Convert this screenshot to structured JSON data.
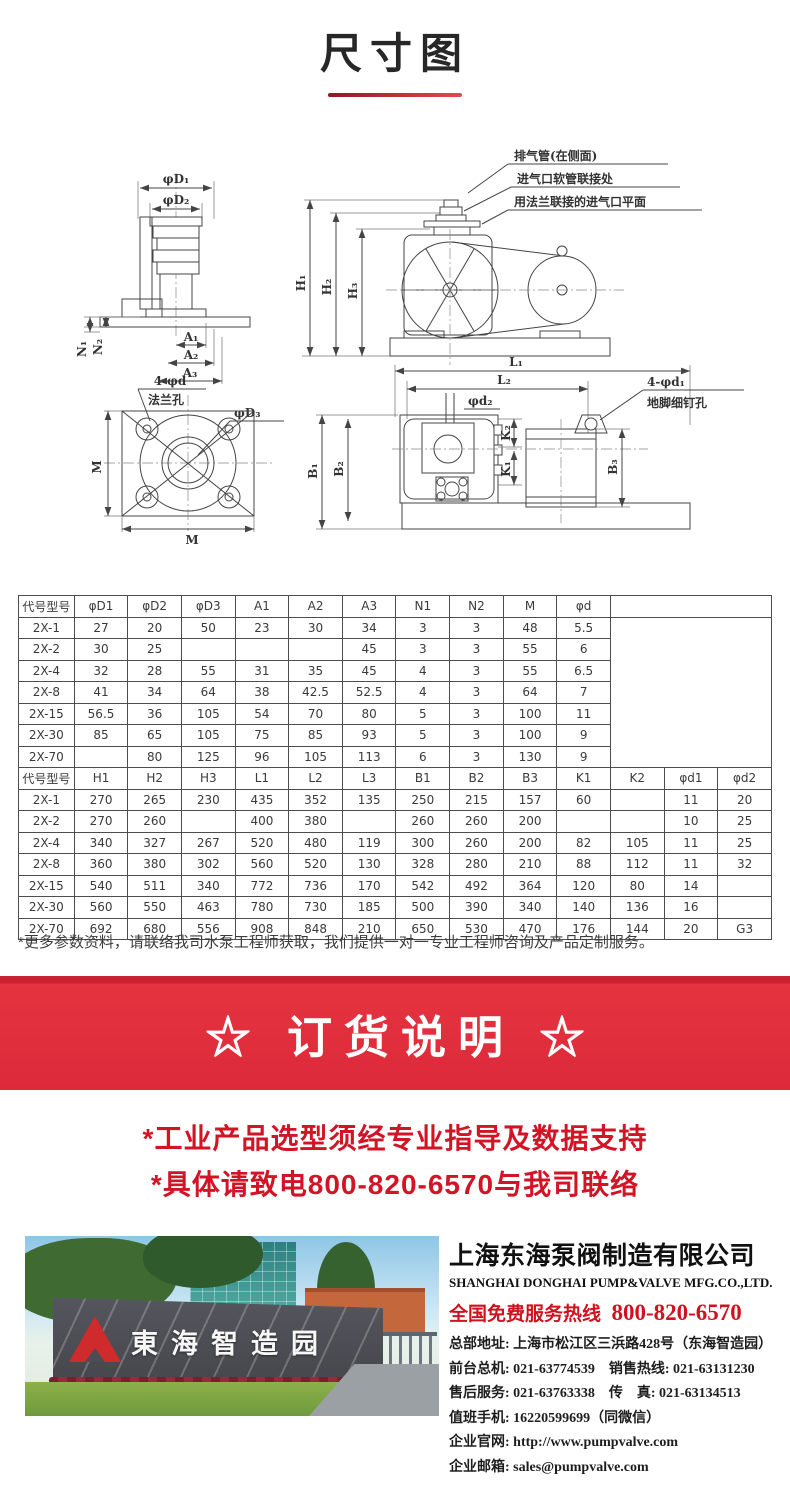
{
  "page": {
    "title": "尺寸图"
  },
  "drawings": {
    "callouts": [
      "排气管(在侧面)",
      "进气口软管联接处",
      "用法兰联接的进气口平面"
    ],
    "labels": {
      "phi_d1": "φD₁",
      "phi_d2": "φD₂",
      "phi_d3": "φD₃",
      "a1": "A₁",
      "a2": "A₂",
      "a3": "A₃",
      "n1": "N₁",
      "n2": "N₂",
      "m_left": "M",
      "m_bottom": "M",
      "flange_holes_line1": "4-φd",
      "flange_holes_line2": "法兰孔",
      "h1": "H₁",
      "h2": "H₂",
      "h3": "H₃",
      "l1": "L₁",
      "l2": "L₂",
      "b1": "B₁",
      "b2": "B₂",
      "b3": "B₃",
      "k1": "K₁",
      "k2": "K₂",
      "phi_d2_top": "φd₂",
      "anchor_holes_line1": "4-φd₁",
      "anchor_holes_line2": "地脚细钉孔"
    }
  },
  "table": {
    "section1": {
      "headers": [
        "代号型号",
        "φD1",
        "φD2",
        "φD3",
        "A1",
        "A2",
        "A3",
        "N1",
        "N2",
        "M",
        "φd"
      ],
      "rows": [
        [
          "2X-1",
          "27",
          "20",
          "50",
          "23",
          "30",
          "34",
          "3",
          "3",
          "48",
          "5.5"
        ],
        [
          "2X-2",
          "30",
          "25",
          "",
          "",
          "",
          "45",
          "3",
          "3",
          "55",
          "6"
        ],
        [
          "2X-4",
          "32",
          "28",
          "55",
          "31",
          "35",
          "45",
          "4",
          "3",
          "55",
          "6.5"
        ],
        [
          "2X-8",
          "41",
          "34",
          "64",
          "38",
          "42.5",
          "52.5",
          "4",
          "3",
          "64",
          "7"
        ],
        [
          "2X-15",
          "56.5",
          "36",
          "105",
          "54",
          "70",
          "80",
          "5",
          "3",
          "100",
          "11"
        ],
        [
          "2X-30",
          "85",
          "65",
          "105",
          "75",
          "85",
          "93",
          "5",
          "3",
          "100",
          "9"
        ],
        [
          "2X-70",
          "",
          "80",
          "125",
          "96",
          "105",
          "113",
          "6",
          "3",
          "130",
          "9"
        ]
      ]
    },
    "section2": {
      "headers": [
        "代号型号",
        "H1",
        "H2",
        "H3",
        "L1",
        "L2",
        "L3",
        "B1",
        "B2",
        "B3",
        "K1",
        "K2",
        "φd1",
        "φd2"
      ],
      "rows": [
        [
          "2X-1",
          "270",
          "265",
          "230",
          "435",
          "352",
          "135",
          "250",
          "215",
          "157",
          "60",
          "",
          "11",
          "20"
        ],
        [
          "2X-2",
          "270",
          "260",
          "",
          "400",
          "380",
          "",
          "260",
          "260",
          "200",
          "",
          "",
          "10",
          "25"
        ],
        [
          "2X-4",
          "340",
          "327",
          "267",
          "520",
          "480",
          "119",
          "300",
          "260",
          "200",
          "82",
          "105",
          "11",
          "25"
        ],
        [
          "2X-8",
          "360",
          "380",
          "302",
          "560",
          "520",
          "130",
          "328",
          "280",
          "210",
          "88",
          "112",
          "11",
          "32"
        ],
        [
          "2X-15",
          "540",
          "511",
          "340",
          "772",
          "736",
          "170",
          "542",
          "492",
          "364",
          "120",
          "80",
          "14",
          ""
        ],
        [
          "2X-30",
          "560",
          "550",
          "463",
          "780",
          "730",
          "185",
          "500",
          "390",
          "340",
          "140",
          "136",
          "16",
          ""
        ],
        [
          "2X-70",
          "692",
          "680",
          "556",
          "908",
          "848",
          "210",
          "650",
          "530",
          "470",
          "176",
          "144",
          "20",
          "G3"
        ]
      ]
    }
  },
  "note": "*更多参数资料，请联络我司水泵工程师获取，我们提供一对一专业工程师咨询及产品定制服务。",
  "order_banner": {
    "title": "☆ 订货说明 ☆"
  },
  "order_notes": [
    "*工业产品选型须经专业指导及数据支持",
    "*具体请致电800-820-6570与我司联络"
  ],
  "footer": {
    "photo_sign": "東海智造园",
    "company_cn": "上海东海泵阀制造有限公司",
    "company_en": "SHANGHAI DONGHAI PUMP&VALVE MFG.CO.,LTD.",
    "hotline_label": "全国免费服务热线",
    "hotline_number": "800-820-6570",
    "contact_lines": [
      "总部地址: 上海市松江区三浜路428号（东海智造园）",
      "前台总机: 021-63774539　销售热线: 021-63131230",
      "售后服务: 021-63763338　传　真: 021-63134513",
      "值班手机: 16220599699（同微信）",
      "企业官网: http://www.pumpvalve.com",
      "企业邮箱: sales@pumpvalve.com"
    ]
  },
  "colors": {
    "accent_red": "#d8232f",
    "banner_red": "#e5333f",
    "text_dark": "#272727"
  }
}
